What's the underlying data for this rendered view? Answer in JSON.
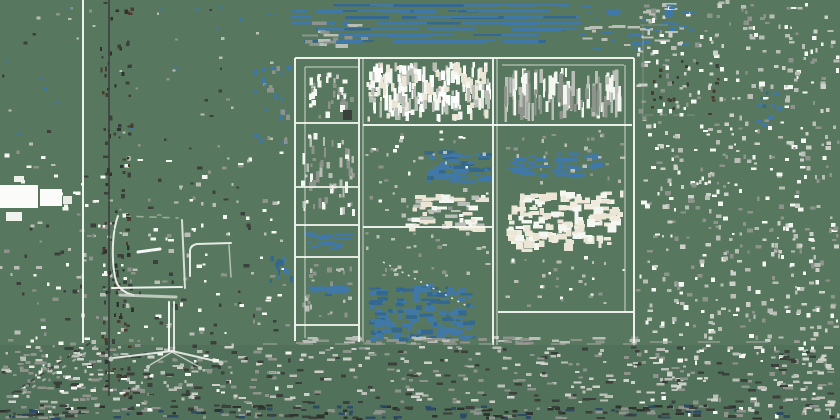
{
  "scene": {
    "description": "Edge-sketch stylized photo of an office interior: a swivel task chair on the left and a large grid shelving unit in the center-right, window frame lines on the far left, blue blind slats at top, over noisy sage-green background",
    "width": 840,
    "height": 420,
    "background": "#57785F",
    "floor": {
      "y": 345,
      "height": 75,
      "color": "#52715A"
    },
    "palette": {
      "sage": "#57785F",
      "floor_sage": "#52715A",
      "white": "#F4F6F2",
      "bright_white": "#FFFFFF",
      "light_gray": "#B9BEB6",
      "mid_gray": "#8E948C",
      "dark_gray": "#3C403C",
      "near_black": "#2E332F",
      "brown": "#4C3C2E",
      "steel_blue": "#4079A8",
      "deep_blue": "#2E4B66",
      "cream": "#EAE5D5"
    },
    "groups": [
      {
        "name": "window-frame",
        "lines": [
          {
            "x1": 83,
            "y1": 0,
            "x2": 83,
            "y2": 343,
            "w": 2,
            "c": "#F7F9F5",
            "o": 0.95
          },
          {
            "x1": 109,
            "y1": 0,
            "x2": 109,
            "y2": 396,
            "w": 2,
            "c": "#3C403C",
            "o": 0.8
          }
        ],
        "patches": [
          {
            "x": 0,
            "y": 185,
            "w": 38,
            "h": 23,
            "c": "#FBFCFA"
          },
          {
            "x": 40,
            "y": 189,
            "w": 22,
            "h": 17,
            "c": "#FBFCFA"
          },
          {
            "x": 6,
            "y": 212,
            "w": 16,
            "h": 9,
            "c": "#F0F2EE"
          },
          {
            "x": 63,
            "y": 196,
            "w": 9,
            "h": 8,
            "c": "#E6E9E4"
          },
          {
            "x": 14,
            "y": 176,
            "w": 10,
            "h": 6,
            "c": "#EDEFEA"
          }
        ]
      },
      {
        "name": "shelving-unit",
        "lines": [
          {
            "x1": 295,
            "y1": 58,
            "x2": 295,
            "y2": 341,
            "w": 2,
            "c": "#F3F5F0",
            "o": 0.95
          },
          {
            "x1": 305,
            "y1": 67,
            "x2": 305,
            "y2": 338,
            "w": 1,
            "c": "#F3F5F0",
            "o": 0.75
          },
          {
            "x1": 359,
            "y1": 58,
            "x2": 359,
            "y2": 342,
            "w": 2,
            "c": "#F3F5F0",
            "o": 0.95
          },
          {
            "x1": 363,
            "y1": 58,
            "x2": 363,
            "y2": 342,
            "w": 1,
            "c": "#F3F5F0",
            "o": 0.75
          },
          {
            "x1": 493,
            "y1": 58,
            "x2": 493,
            "y2": 345,
            "w": 2,
            "c": "#F3F5F0",
            "o": 0.95
          },
          {
            "x1": 497,
            "y1": 58,
            "x2": 497,
            "y2": 345,
            "w": 1,
            "c": "#F3F5F0",
            "o": 0.75
          },
          {
            "x1": 625,
            "y1": 65,
            "x2": 625,
            "y2": 312,
            "w": 1,
            "c": "#F3F5F0",
            "o": 0.75
          },
          {
            "x1": 634,
            "y1": 58,
            "x2": 634,
            "y2": 345,
            "w": 2,
            "c": "#F3F5F0",
            "o": 0.95
          },
          {
            "x1": 295,
            "y1": 58,
            "x2": 634,
            "y2": 58,
            "w": 2,
            "c": "#F3F5F0",
            "o": 0.95
          },
          {
            "x1": 305,
            "y1": 67,
            "x2": 358,
            "y2": 67,
            "w": 1,
            "c": "#F3F5F0",
            "o": 0.75
          },
          {
            "x1": 502,
            "y1": 65,
            "x2": 624,
            "y2": 65,
            "w": 1,
            "c": "#F3F5F0",
            "o": 0.75
          },
          {
            "x1": 295,
            "y1": 123,
            "x2": 358,
            "y2": 123,
            "w": 2,
            "c": "#F3F5F0",
            "o": 0.9
          },
          {
            "x1": 363,
            "y1": 125,
            "x2": 632,
            "y2": 125,
            "w": 2,
            "c": "#F3F5F0",
            "o": 0.95
          },
          {
            "x1": 295,
            "y1": 187,
            "x2": 358,
            "y2": 187,
            "w": 2,
            "c": "#F3F5F0",
            "o": 0.85
          },
          {
            "x1": 295,
            "y1": 225,
            "x2": 358,
            "y2": 225,
            "w": 2,
            "c": "#F3F5F0",
            "o": 0.9
          },
          {
            "x1": 363,
            "y1": 227,
            "x2": 493,
            "y2": 227,
            "w": 2,
            "c": "#F3F5F0",
            "o": 0.95
          },
          {
            "x1": 295,
            "y1": 257,
            "x2": 358,
            "y2": 257,
            "w": 2,
            "c": "#F3F5F0",
            "o": 0.9
          },
          {
            "x1": 498,
            "y1": 312,
            "x2": 634,
            "y2": 312,
            "w": 2,
            "c": "#F3F5F0",
            "o": 0.95
          },
          {
            "x1": 295,
            "y1": 325,
            "x2": 358,
            "y2": 325,
            "w": 2,
            "c": "#F3F5F0",
            "o": 0.9
          },
          {
            "x1": 383,
            "y1": 262,
            "x2": 467,
            "y2": 306,
            "w": 1.5,
            "c": "#F3F5F0",
            "dash": "2 5",
            "o": 0.9
          }
        ],
        "patches": [
          {
            "x": 343,
            "y": 110,
            "w": 9,
            "h": 10,
            "c": "#3C403C"
          }
        ]
      },
      {
        "name": "office-chair",
        "paths": [
          {
            "d": "M118,216 C112,232 111,262 116,281 C119,289 125,293 133,295",
            "w": 2,
            "c": "#EFF1EC",
            "o": 0.95
          },
          {
            "d": "M182,220 L185,288",
            "w": 2,
            "c": "#EFF1EC",
            "o": 0.85
          },
          {
            "d": "M124,216 L178,218",
            "w": 1.5,
            "c": "#EFF1EC",
            "dash": "6 7",
            "o": 0.45
          },
          {
            "d": "M190,276 L190,250 Q191,245 197,244 L231,243",
            "w": 2,
            "c": "#EFF1EC",
            "o": 0.95
          },
          {
            "d": "M229,245 L231,277",
            "w": 1.5,
            "c": "#EFF1EC",
            "o": 0.6
          },
          {
            "d": "M112,288 L182,287",
            "w": 2,
            "c": "#F7F9F5",
            "o": 0.95
          },
          {
            "d": "M120,295 L176,297",
            "w": 3,
            "c": "#D9DCD5",
            "o": 0.8
          },
          {
            "d": "M138,252 L160,249",
            "w": 3,
            "c": "#FFFFFF",
            "o": 0.95
          },
          {
            "d": "M169,302 L169,351",
            "w": 2,
            "c": "#FFFFFF",
            "o": 0.95
          },
          {
            "d": "M174,302 L174,351",
            "w": 2,
            "c": "#EFF1EC",
            "o": 0.9
          },
          {
            "d": "M172,351 L113,358",
            "w": 2,
            "c": "#EFF1EC",
            "o": 0.9
          },
          {
            "d": "M172,351 L220,362",
            "w": 2,
            "c": "#EFF1EC",
            "o": 0.9
          },
          {
            "d": "M172,352 L150,365",
            "w": 1.5,
            "c": "#EFF1EC",
            "o": 0.7
          },
          {
            "d": "M172,352 L198,366",
            "w": 1.5,
            "c": "#EFF1EC",
            "o": 0.7
          }
        ],
        "dots": [
          {
            "cx": 111,
            "cy": 359,
            "r": 2.5,
            "c": "#C6CAC2"
          },
          {
            "cx": 221,
            "cy": 363,
            "r": 2.5,
            "c": "#C6CAC2"
          },
          {
            "cx": 148,
            "cy": 367,
            "r": 2,
            "c": "#C6CAC2"
          },
          {
            "cx": 200,
            "cy": 368,
            "r": 2,
            "c": "#C6CAC2"
          }
        ]
      },
      {
        "name": "floor-markings",
        "lines": [
          {
            "x1": 90,
            "y1": 343,
            "x2": 8,
            "y2": 396,
            "w": 2,
            "c": "#3C403C",
            "dash": "5 6",
            "o": 0.85
          },
          {
            "x1": 96,
            "y1": 346,
            "x2": 16,
            "y2": 398,
            "w": 2,
            "c": "#B9BEB6",
            "dash": "4 8",
            "o": 0.8
          },
          {
            "x1": 263,
            "y1": 344,
            "x2": 640,
            "y2": 344,
            "w": 2,
            "c": "#9AA098",
            "dash": "14 22",
            "o": 0.6
          },
          {
            "x1": 650,
            "y1": 342,
            "x2": 800,
            "y2": 342,
            "w": 2,
            "c": "#9AA098",
            "dash": "22 26",
            "o": 0.65
          },
          {
            "x1": 643,
            "y1": 25,
            "x2": 643,
            "y2": 118,
            "w": 1,
            "c": "#A7ACA4",
            "o": 0.5
          },
          {
            "x1": 640,
            "y1": 25,
            "x2": 668,
            "y2": 25,
            "w": 1,
            "c": "#A7ACA4",
            "o": 0.5
          },
          {
            "x1": 645,
            "y1": 115,
            "x2": 700,
            "y2": 115,
            "w": 1,
            "c": "#A7ACA4",
            "dash": "8 6",
            "o": 0.5
          }
        ]
      }
    ],
    "noise_regions": [
      {
        "name": "noise-blinds",
        "x": 286,
        "y": 4,
        "w": 296,
        "h": 46,
        "n": 110,
        "colors": [
          "#4079A8",
          "#4079A8",
          "#35688F"
        ],
        "wmin": 6,
        "wmax": 55,
        "hmin": 2,
        "hmax": 3,
        "snap": 6
      },
      {
        "name": "noise-blinds-right",
        "x": 580,
        "y": 2,
        "w": 110,
        "h": 50,
        "n": 40,
        "colors": [
          "#4079A8",
          "#B9BEB6"
        ],
        "wmin": 3,
        "wmax": 14,
        "hmin": 2,
        "hmax": 3
      },
      {
        "name": "noise-blinds-gray",
        "x": 300,
        "y": 20,
        "w": 70,
        "h": 28,
        "n": 18,
        "colors": [
          "#8E948C",
          "#B9BEB6"
        ],
        "wmin": 4,
        "wmax": 16,
        "hmin": 2,
        "hmax": 4
      },
      {
        "name": "books-top-middle",
        "x": 366,
        "y": 62,
        "w": 125,
        "h": 60,
        "n": 230,
        "colors": [
          "#F4F6F2",
          "#EAE5D5",
          "#B9BEB6",
          "#FFFFFF"
        ],
        "wmin": 2,
        "wmax": 5,
        "hmin": 4,
        "hmax": 16
      },
      {
        "name": "books-top-right",
        "x": 503,
        "y": 68,
        "w": 119,
        "h": 54,
        "n": 120,
        "colors": [
          "#F4F6F2",
          "#B9BEB6",
          "#8E948C"
        ],
        "wmin": 2,
        "wmax": 4,
        "hmin": 6,
        "hmax": 28
      },
      {
        "name": "books-top-left",
        "x": 308,
        "y": 72,
        "w": 48,
        "h": 48,
        "n": 35,
        "colors": [
          "#B9BEB6",
          "#8E948C",
          "#F4F6F2"
        ],
        "wmin": 2,
        "wmax": 5,
        "hmin": 3,
        "hmax": 8
      },
      {
        "name": "shelf-left-mid-items",
        "x": 300,
        "y": 130,
        "w": 56,
        "h": 88,
        "n": 55,
        "colors": [
          "#F4F6F2",
          "#B9BEB6",
          "#8E948C"
        ],
        "wmin": 2,
        "wmax": 4,
        "hmin": 3,
        "hmax": 12
      },
      {
        "name": "shelf-left-lower-items",
        "x": 300,
        "y": 260,
        "w": 56,
        "h": 58,
        "n": 25,
        "colors": [
          "#B9BEB6",
          "#8E948C"
        ],
        "wmin": 2,
        "wmax": 5,
        "hmin": 2,
        "hmax": 6
      },
      {
        "name": "blue-dashes-left-col",
        "x": 302,
        "y": 232,
        "w": 52,
        "h": 18,
        "n": 22,
        "colors": [
          "#4079A8"
        ],
        "wmin": 4,
        "wmax": 14,
        "hmin": 2,
        "hmax": 3
      },
      {
        "name": "blue-line-left-col",
        "x": 304,
        "y": 286,
        "w": 48,
        "h": 10,
        "n": 16,
        "colors": [
          "#4079A8",
          "#35688F"
        ],
        "wmin": 6,
        "wmax": 20,
        "hmin": 2,
        "hmax": 3
      },
      {
        "name": "blue-cluster-middle",
        "x": 424,
        "y": 150,
        "w": 70,
        "h": 36,
        "n": 55,
        "colors": [
          "#4079A8",
          "#35688F"
        ],
        "wmin": 4,
        "wmax": 16,
        "hmin": 2,
        "hmax": 4
      },
      {
        "name": "blue-dashes-right-cell",
        "x": 505,
        "y": 152,
        "w": 100,
        "h": 26,
        "n": 45,
        "colors": [
          "#4079A8"
        ],
        "wmin": 4,
        "wmax": 18,
        "hmin": 2,
        "hmax": 4
      },
      {
        "name": "cream-dashes-middle",
        "x": 400,
        "y": 194,
        "w": 92,
        "h": 38,
        "n": 55,
        "colors": [
          "#EAE5D5",
          "#F4F6F2",
          "#B9BEB6"
        ],
        "wmin": 4,
        "wmax": 16,
        "hmin": 2,
        "hmax": 5
      },
      {
        "name": "cream-cluster-right",
        "x": 506,
        "y": 190,
        "w": 118,
        "h": 62,
        "n": 150,
        "colors": [
          "#EAE5D5",
          "#EFEBDD",
          "#F4F6F2"
        ],
        "wmin": 3,
        "wmax": 11,
        "hmin": 3,
        "hmax": 8
      },
      {
        "name": "blue-cluster-bottom-middle",
        "x": 366,
        "y": 284,
        "w": 110,
        "h": 58,
        "n": 140,
        "colors": [
          "#4079A8",
          "#35688F",
          "#4079A8"
        ],
        "wmin": 3,
        "wmax": 13,
        "hmin": 2,
        "hmax": 5
      },
      {
        "name": "speckle-middle-cell",
        "x": 365,
        "y": 130,
        "w": 126,
        "h": 92,
        "n": 40,
        "colors": [
          "#B9BEB6",
          "#F4F6F2",
          "#8E948C"
        ],
        "wmin": 2,
        "wmax": 5,
        "hmin": 2,
        "hmax": 4
      },
      {
        "name": "speckle-middle-lower",
        "x": 365,
        "y": 232,
        "w": 126,
        "h": 48,
        "n": 28,
        "colors": [
          "#B9BEB6",
          "#8E948C"
        ],
        "wmin": 2,
        "wmax": 5,
        "hmin": 2,
        "hmax": 4
      },
      {
        "name": "speckle-right-cell-mid",
        "x": 500,
        "y": 130,
        "w": 130,
        "h": 55,
        "n": 30,
        "colors": [
          "#B9BEB6",
          "#8E948C"
        ],
        "wmin": 2,
        "wmax": 5,
        "hmin": 2,
        "hmax": 4
      },
      {
        "name": "speckle-right-cell-lower",
        "x": 500,
        "y": 256,
        "w": 130,
        "h": 52,
        "n": 32,
        "colors": [
          "#B9BEB6",
          "#8E948C",
          "#F4F6F2"
        ],
        "wmin": 2,
        "wmax": 5,
        "hmin": 2,
        "hmax": 4
      },
      {
        "name": "speckle-right-side",
        "x": 636,
        "y": 0,
        "w": 204,
        "h": 420,
        "n": 620,
        "colors": [
          "#B9BEB6",
          "#8E948C",
          "#CDD1CA",
          "#F4F6F2"
        ],
        "wmin": 2,
        "wmax": 6,
        "hmin": 2,
        "hmax": 5
      },
      {
        "name": "brown-dots-right",
        "x": 650,
        "y": 35,
        "w": 70,
        "h": 80,
        "n": 24,
        "colors": [
          "#4C3C2E",
          "#3C403C"
        ],
        "wmin": 2,
        "wmax": 4,
        "hmin": 2,
        "hmax": 4
      },
      {
        "name": "blue-specks-right-top",
        "x": 640,
        "y": 4,
        "w": 60,
        "h": 30,
        "n": 16,
        "colors": [
          "#4079A8"
        ],
        "wmin": 3,
        "wmax": 9,
        "hmin": 2,
        "hmax": 3
      },
      {
        "name": "blue-specks-right-mid",
        "x": 755,
        "y": 90,
        "w": 45,
        "h": 40,
        "n": 12,
        "colors": [
          "#4079A8",
          "#35688F"
        ],
        "wmin": 2,
        "wmax": 6,
        "hmin": 2,
        "hmax": 4
      },
      {
        "name": "speckle-left-side",
        "x": 0,
        "y": 150,
        "w": 292,
        "h": 270,
        "n": 330,
        "colors": [
          "#B9BEB6",
          "#8E948C",
          "#F4F6F2",
          "#3C403C"
        ],
        "wmin": 2,
        "wmax": 6,
        "hmin": 2,
        "hmax": 4
      },
      {
        "name": "speckle-upper-left",
        "x": 0,
        "y": 0,
        "w": 290,
        "h": 150,
        "n": 55,
        "colors": [
          "#8E948C",
          "#3C403C",
          "#4079A8",
          "#B9BEB6"
        ],
        "wmin": 2,
        "wmax": 4,
        "hmin": 2,
        "hmax": 3
      },
      {
        "name": "dark-speckle-doorline",
        "x": 100,
        "y": 0,
        "w": 34,
        "h": 400,
        "n": 120,
        "colors": [
          "#3C403C",
          "#4C3C2E",
          "#2E332F"
        ],
        "wmin": 2,
        "wmax": 4,
        "hmin": 2,
        "hmax": 5
      },
      {
        "name": "blue-specks-left-of-shelf",
        "x": 252,
        "y": 62,
        "w": 40,
        "h": 88,
        "n": 26,
        "colors": [
          "#4079A8",
          "#8E948C"
        ],
        "wmin": 2,
        "wmax": 5,
        "hmin": 2,
        "hmax": 6
      },
      {
        "name": "blue-specks-left-of-shelf-lower",
        "x": 265,
        "y": 255,
        "w": 28,
        "h": 30,
        "n": 12,
        "colors": [
          "#4079A8",
          "#35688F"
        ],
        "wmin": 2,
        "wmax": 4,
        "hmin": 3,
        "hmax": 8
      },
      {
        "name": "floor-speckle",
        "x": 0,
        "y": 346,
        "w": 840,
        "h": 58,
        "n": 420,
        "colors": [
          "#8E948C",
          "#B9BEB6",
          "#3C403C",
          "#CDD1CA"
        ],
        "wmin": 3,
        "wmax": 9,
        "hmin": 2,
        "hmax": 3
      },
      {
        "name": "bottom-band",
        "x": 0,
        "y": 404,
        "w": 840,
        "h": 16,
        "n": 210,
        "colors": [
          "#2E332F",
          "#2E4B66",
          "#8E948C",
          "#3C403C"
        ],
        "wmin": 3,
        "wmax": 10,
        "hmin": 2,
        "hmax": 3
      },
      {
        "name": "cream-specks-bottom-left",
        "x": 10,
        "y": 345,
        "w": 110,
        "h": 55,
        "n": 36,
        "colors": [
          "#EAE5D5",
          "#F4F6F2",
          "#8E948C"
        ],
        "wmin": 2,
        "wmax": 6,
        "hmin": 2,
        "hmax": 3
      },
      {
        "name": "shelf-shadow-dashes",
        "x": 295,
        "y": 336,
        "w": 345,
        "h": 9,
        "n": 55,
        "colors": [
          "#8E948C",
          "#B9BEB6"
        ],
        "wmin": 4,
        "wmax": 14,
        "hmin": 2,
        "hmax": 3
      }
    ]
  }
}
